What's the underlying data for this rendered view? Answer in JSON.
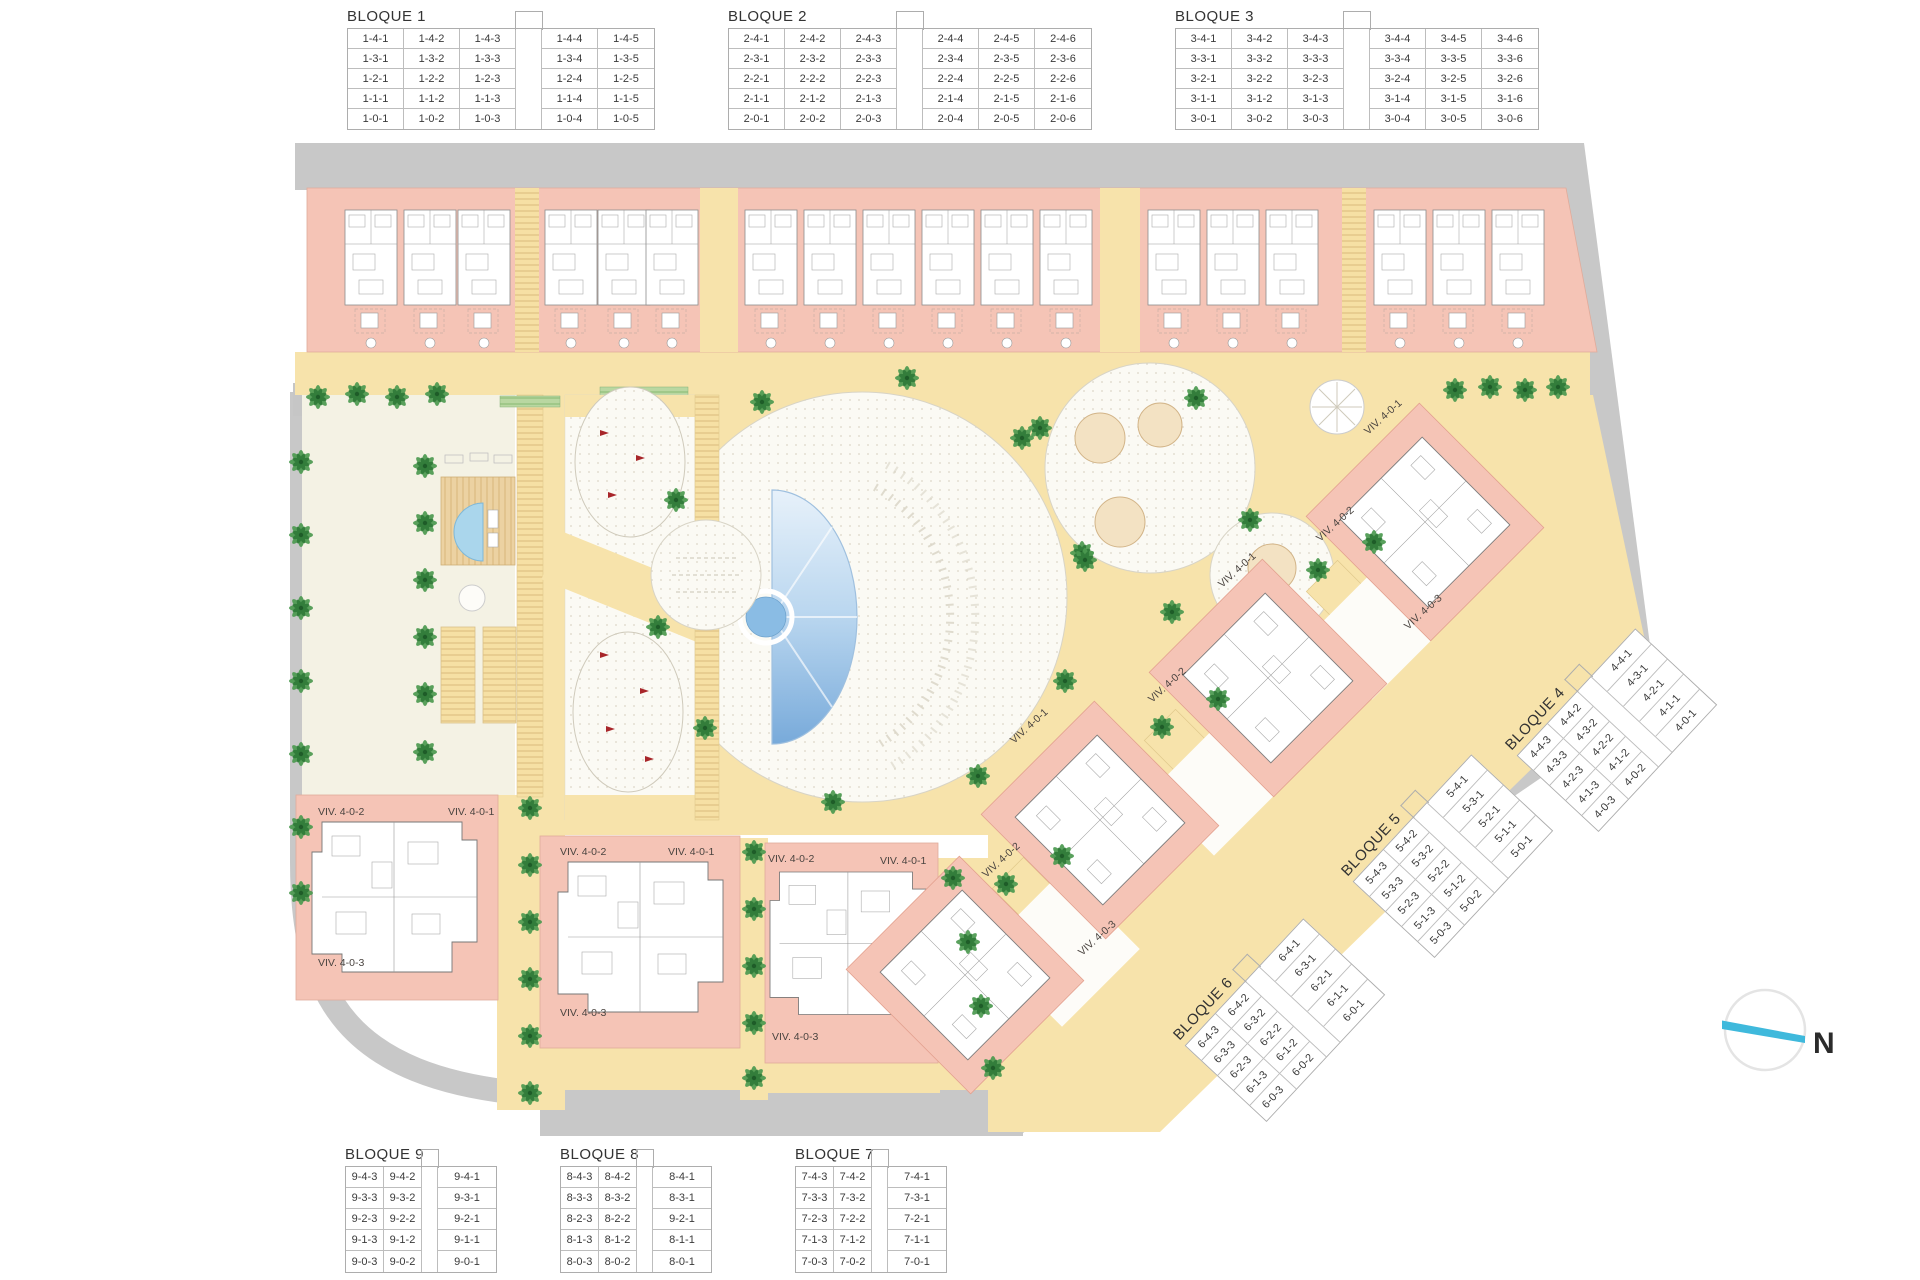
{
  "plan": {
    "viv_labels": {
      "v1": "VIV. 4-0-1",
      "v2": "VIV. 4-0-2",
      "v3": "VIV. 4-0-3"
    },
    "compass_label": "N"
  },
  "colors": {
    "building_salmon": "#f5c4b6",
    "path_yellow": "#f7e3ab",
    "road_gray": "#c8c8c8",
    "pool_blue": "#7fb0e0",
    "palm_green": "#4c9a50",
    "compass_blue": "#3fb9dc"
  },
  "tables": {
    "bloque1": {
      "title": "BLOQUE 1",
      "rows": [
        [
          "1-4-1",
          "1-4-2",
          "1-4-3",
          "",
          "1-4-4",
          "1-4-5"
        ],
        [
          "1-3-1",
          "1-3-2",
          "1-3-3",
          "",
          "1-3-4",
          "1-3-5"
        ],
        [
          "1-2-1",
          "1-2-2",
          "1-2-3",
          "",
          "1-2-4",
          "1-2-5"
        ],
        [
          "1-1-1",
          "1-1-2",
          "1-1-3",
          "",
          "1-1-4",
          "1-1-5"
        ],
        [
          "1-0-1",
          "1-0-2",
          "1-0-3",
          "",
          "1-0-4",
          "1-0-5"
        ]
      ]
    },
    "bloque2": {
      "title": "BLOQUE 2",
      "rows": [
        [
          "2-4-1",
          "2-4-2",
          "2-4-3",
          "",
          "2-4-4",
          "2-4-5",
          "2-4-6"
        ],
        [
          "2-3-1",
          "2-3-2",
          "2-3-3",
          "",
          "2-3-4",
          "2-3-5",
          "2-3-6"
        ],
        [
          "2-2-1",
          "2-2-2",
          "2-2-3",
          "",
          "2-2-4",
          "2-2-5",
          "2-2-6"
        ],
        [
          "2-1-1",
          "2-1-2",
          "2-1-3",
          "",
          "2-1-4",
          "2-1-5",
          "2-1-6"
        ],
        [
          "2-0-1",
          "2-0-2",
          "2-0-3",
          "",
          "2-0-4",
          "2-0-5",
          "2-0-6"
        ]
      ]
    },
    "bloque3": {
      "title": "BLOQUE 3",
      "rows": [
        [
          "3-4-1",
          "3-4-2",
          "3-4-3",
          "",
          "3-4-4",
          "3-4-5",
          "3-4-6"
        ],
        [
          "3-3-1",
          "3-3-2",
          "3-3-3",
          "",
          "3-3-4",
          "3-3-5",
          "3-3-6"
        ],
        [
          "3-2-1",
          "3-2-2",
          "3-2-3",
          "",
          "3-2-4",
          "3-2-5",
          "3-2-6"
        ],
        [
          "3-1-1",
          "3-1-2",
          "3-1-3",
          "",
          "3-1-4",
          "3-1-5",
          "3-1-6"
        ],
        [
          "3-0-1",
          "3-0-2",
          "3-0-3",
          "",
          "3-0-4",
          "3-0-5",
          "3-0-6"
        ]
      ]
    },
    "bloque4": {
      "title": "BLOQUE 4",
      "rows": [
        [
          "4-4-3",
          "4-4-2",
          "",
          "4-4-1"
        ],
        [
          "4-3-3",
          "4-3-2",
          "",
          "4-3-1"
        ],
        [
          "4-2-3",
          "4-2-2",
          "",
          "4-2-1"
        ],
        [
          "4-1-3",
          "4-1-2",
          "",
          "4-1-1"
        ],
        [
          "4-0-3",
          "4-0-2",
          "",
          "4-0-1"
        ]
      ]
    },
    "bloque5": {
      "title": "BLOQUE 5",
      "rows": [
        [
          "5-4-3",
          "5-4-2",
          "",
          "5-4-1"
        ],
        [
          "5-3-3",
          "5-3-2",
          "",
          "5-3-1"
        ],
        [
          "5-2-3",
          "5-2-2",
          "",
          "5-2-1"
        ],
        [
          "5-1-3",
          "5-1-2",
          "",
          "5-1-1"
        ],
        [
          "5-0-3",
          "5-0-2",
          "",
          "5-0-1"
        ]
      ]
    },
    "bloque6": {
      "title": "BLOQUE 6",
      "rows": [
        [
          "6-4-3",
          "6-4-2",
          "",
          "6-4-1"
        ],
        [
          "6-3-3",
          "6-3-2",
          "",
          "6-3-1"
        ],
        [
          "6-2-3",
          "6-2-2",
          "",
          "6-2-1"
        ],
        [
          "6-1-3",
          "6-1-2",
          "",
          "6-1-1"
        ],
        [
          "6-0-3",
          "6-0-2",
          "",
          "6-0-1"
        ]
      ]
    },
    "bloque7": {
      "title": "BLOQUE 7",
      "rows": [
        [
          "7-4-3",
          "7-4-2",
          "",
          "7-4-1"
        ],
        [
          "7-3-3",
          "7-3-2",
          "",
          "7-3-1"
        ],
        [
          "7-2-3",
          "7-2-2",
          "",
          "7-2-1"
        ],
        [
          "7-1-3",
          "7-1-2",
          "",
          "7-1-1"
        ],
        [
          "7-0-3",
          "7-0-2",
          "",
          "7-0-1"
        ]
      ]
    },
    "bloque8": {
      "title": "BLOQUE 8",
      "rows": [
        [
          "8-4-3",
          "8-4-2",
          "",
          "8-4-1"
        ],
        [
          "8-3-3",
          "8-3-2",
          "",
          "8-3-1"
        ],
        [
          "8-2-3",
          "8-2-2",
          "",
          "9-2-1"
        ],
        [
          "8-1-3",
          "8-1-2",
          "",
          "8-1-1"
        ],
        [
          "8-0-3",
          "8-0-2",
          "",
          "8-0-1"
        ]
      ]
    },
    "bloque9": {
      "title": "BLOQUE 9",
      "rows": [
        [
          "9-4-3",
          "9-4-2",
          "",
          "9-4-1"
        ],
        [
          "9-3-3",
          "9-3-2",
          "",
          "9-3-1"
        ],
        [
          "9-2-3",
          "9-2-2",
          "",
          "9-2-1"
        ],
        [
          "9-1-3",
          "9-1-2",
          "",
          "9-1-1"
        ],
        [
          "9-0-3",
          "9-0-2",
          "",
          "9-0-1"
        ]
      ]
    }
  }
}
